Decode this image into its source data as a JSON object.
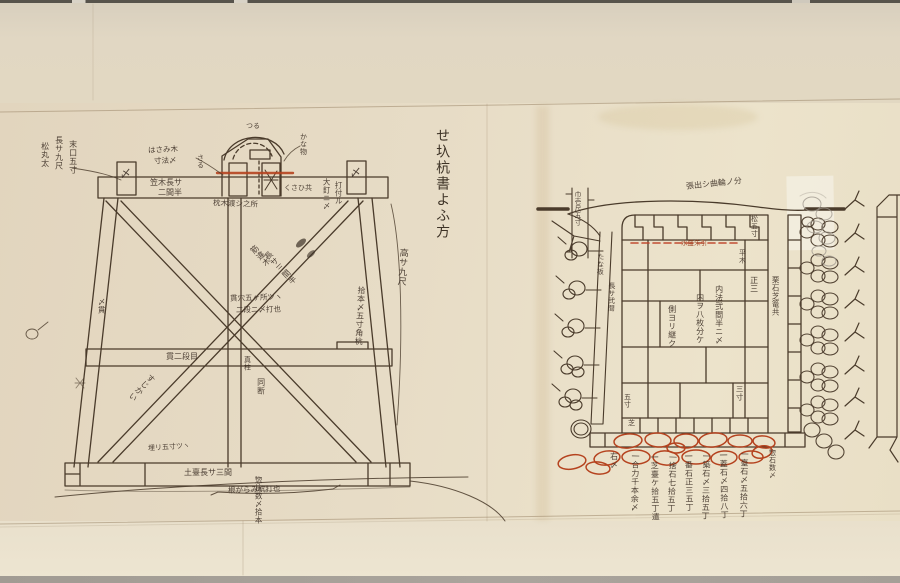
{
  "scroll": {
    "title": "せ圦杭書よふ方",
    "colors": {
      "paper": "#e7dcc6",
      "ink": "#4a3b2b",
      "red_ink": "#b5431f",
      "pencil": "#9d968c"
    },
    "left_diagram": {
      "labels": {
        "material_col1": "松丸太",
        "material_col2": "長サ九尺",
        "material_col3": "末口五寸",
        "clamp_note_1": "はさみ木",
        "clamp_note_2": "寸法〆",
        "beam_note_1": "笠木長サ",
        "beam_note_2": "二間半",
        "cap_top": "つる",
        "cap_left": "さる",
        "cap_right": "かな物",
        "cap_under": "枕木渡シ之所",
        "wedge_note": "くさひ共",
        "nail_note_1": "大釘ニ〆",
        "nail_note_2": "打付ル",
        "shime_left": "〆",
        "shime_right": "〆",
        "brace_note_1": "筋違木",
        "brace_note_2": "長サ三間半",
        "brace_lower_left": "すじかい",
        "brace_lower_right": "同断",
        "center_note_1": "貫穴五ヶ所ツヽ",
        "center_note_2": "二段ニ〆打也",
        "tie_note": "貫二段目",
        "post_note": "真柱",
        "height_note": "高サ九尺",
        "post_right_note": "拾本〆五寸角杭",
        "small_mark": "〆貫",
        "base_note": "土臺長サ三間",
        "base_embed_note": "埋リ五寸ツヽ",
        "base_under_note": "根がらみ杭打也",
        "count_note": "惣杭数〆拾本"
      }
    },
    "right_diagram": {
      "labels": {
        "curve_note": "張出シ曲輪ノ分",
        "pole_note": "巾壱尺五寸",
        "plank_note_1": "たな板",
        "plank_note_2": "長サ弐間",
        "crest_note": "松五寸",
        "red_note": "水盛朱引",
        "level_note": "平木",
        "cell_note": "正三",
        "inner_col_1": "内法弐間半ニ〆",
        "inner_col_2": "内ヲ八枚分ケ",
        "inner_col_3": "側ヨリ継ク",
        "right_outer": "栗石芝篭共",
        "mid_right": "三寸",
        "small_left_1": "五寸",
        "small_left_2": "芝",
        "sill_right": "惣石数〆"
      },
      "tally_columns": [
        "一臺石〆五拾六丁",
        "一蓋石〆四拾八丁",
        "一築石〆三拾五丁",
        "一番石正三五丁",
        "一捨石七拾五丁",
        "一芝臺ケ拾五丁遣",
        "一合力千本余〆",
        "右〆"
      ]
    }
  }
}
